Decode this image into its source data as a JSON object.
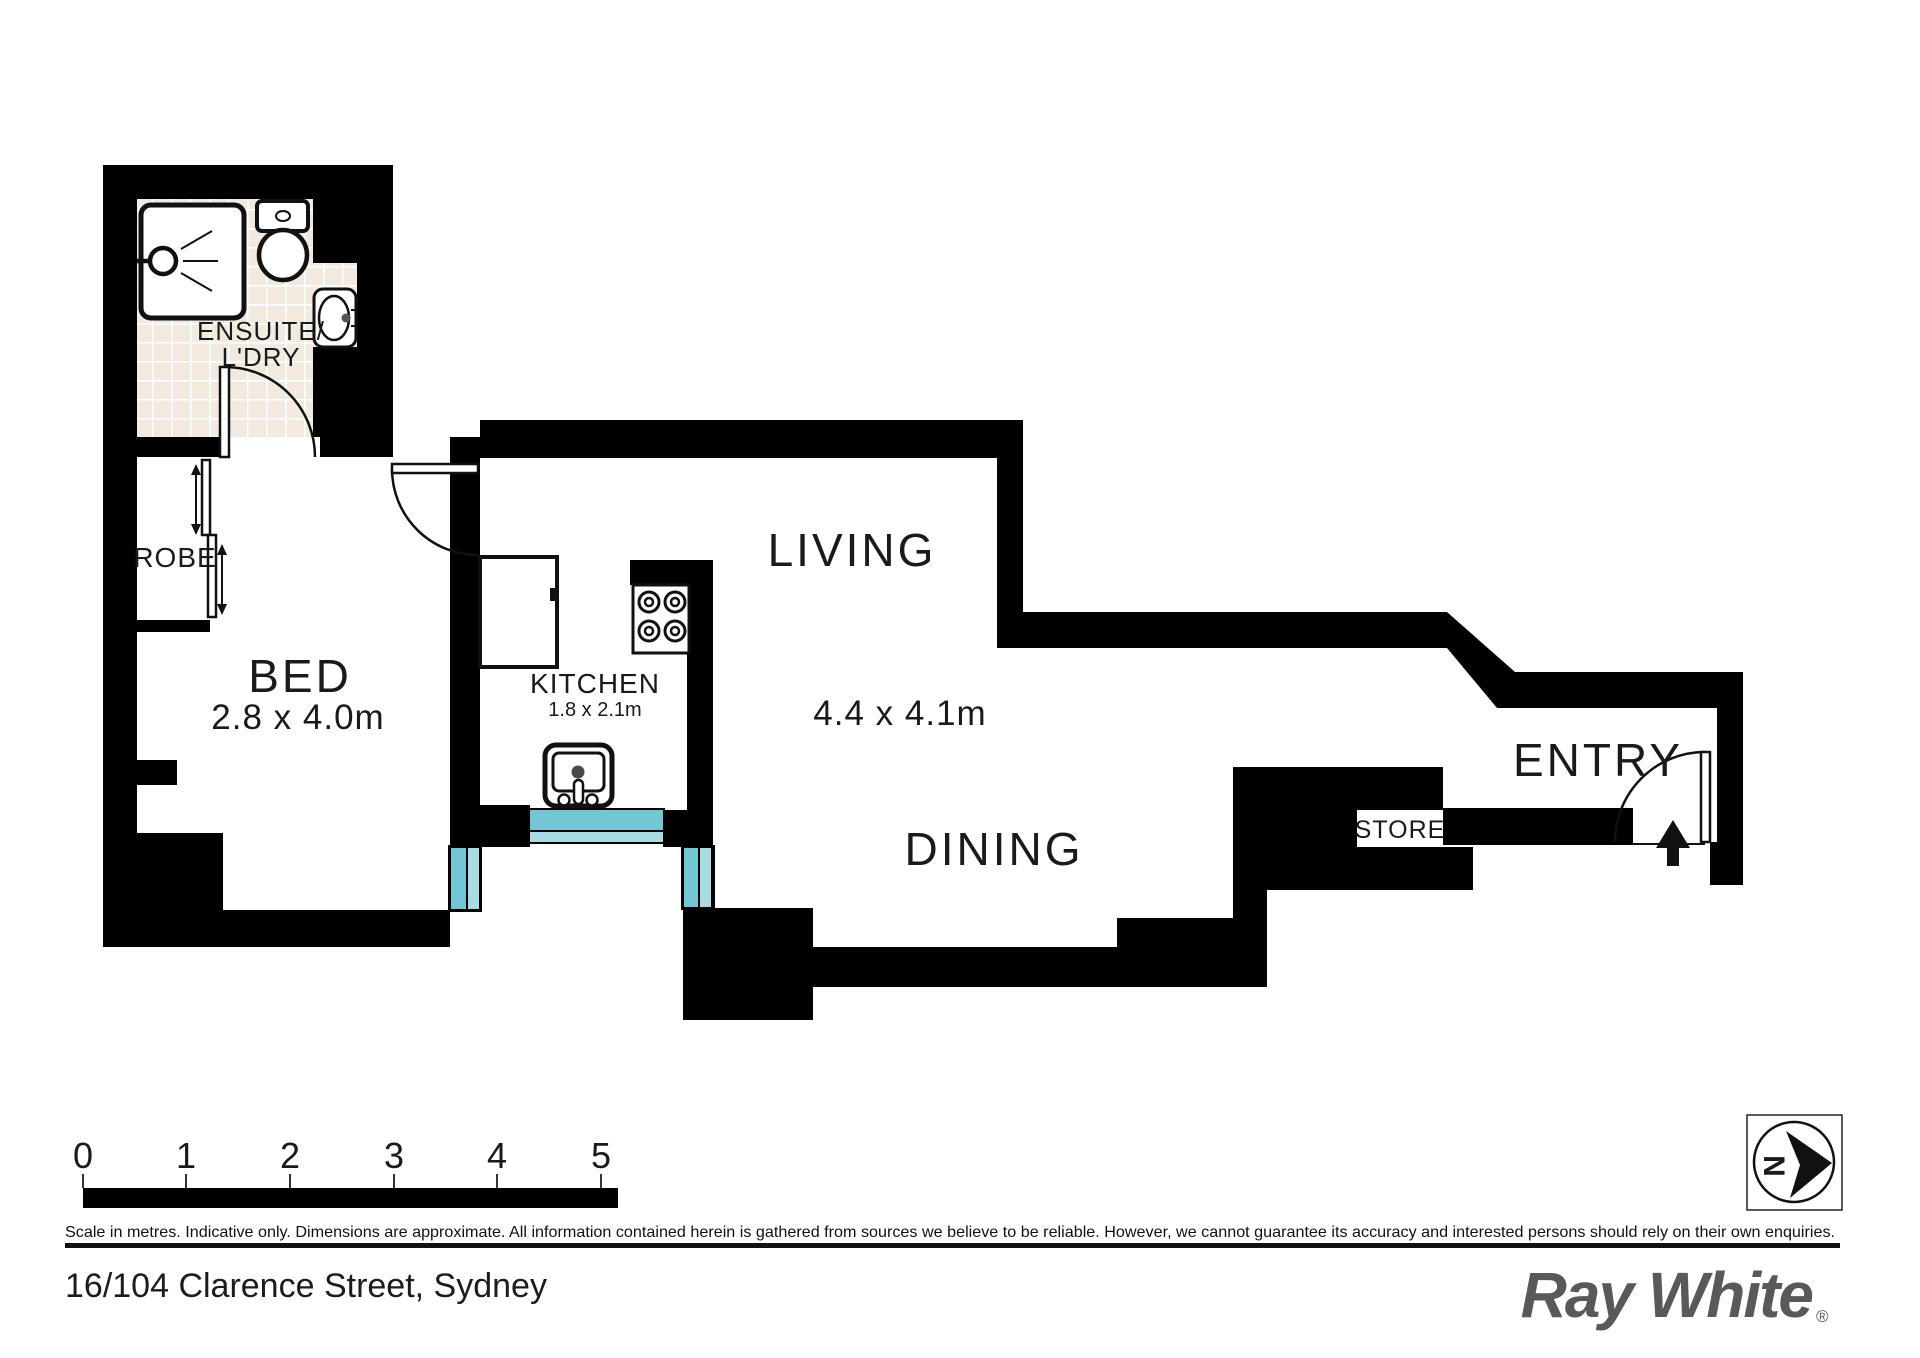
{
  "floorplan": {
    "rooms": {
      "ensuite": {
        "label_line1": "ENSUITE/",
        "label_line2": "L'DRY"
      },
      "robe": {
        "label": "ROBE"
      },
      "bed": {
        "label": "BED",
        "dims": "2.8 x 4.0m"
      },
      "kitchen": {
        "label": "KITCHEN",
        "dims": "1.8 x 2.1m"
      },
      "living": {
        "label": "LIVING",
        "dims": "4.4 x 4.1m"
      },
      "dining": {
        "label": "DINING"
      },
      "entry": {
        "label": "ENTRY"
      },
      "store": {
        "label": "STORE"
      }
    },
    "compass_letter": "N"
  },
  "scale_bar": {
    "ticks": [
      "0",
      "1",
      "2",
      "3",
      "4",
      "5"
    ]
  },
  "footer": {
    "disclaimer": "Scale in metres. Indicative only. Dimensions are approximate. All information contained herein is gathered from sources we believe to be reliable. However, we cannot guarantee its accuracy and interested persons should rely on their own enquiries.",
    "address": "16/104 Clarence Street, Sydney",
    "brand": "Ray White",
    "brand_mark": "®"
  },
  "colors": {
    "wall": "#000000",
    "window_dark": "#73c6d4",
    "window_light": "#a9dbe2",
    "tile": "#f2eadf",
    "brand_gray": "#58595b",
    "text": "#1a1a1a"
  }
}
